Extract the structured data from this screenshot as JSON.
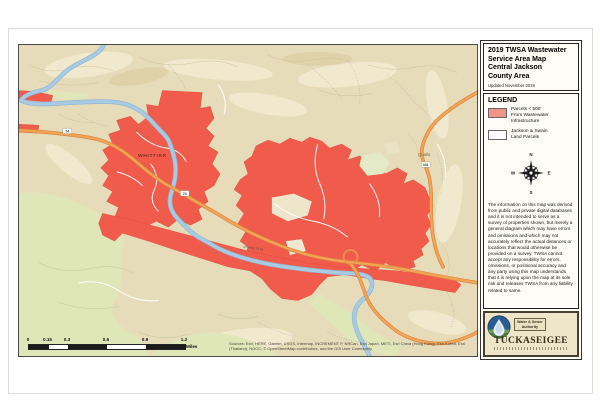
{
  "sheet": {
    "title_lines": [
      "2019 TWSA Wastewater",
      "Service Area Map",
      "Central Jackson",
      "County Area"
    ],
    "updated": "Updated November 2019"
  },
  "legend": {
    "header": "LEGEND",
    "items": [
      {
        "swatch_color": "#f2938a",
        "lines": [
          "Parcels < 500'",
          "From Wastewater",
          "Infrastructure"
        ]
      },
      {
        "swatch_color": "#ffffff",
        "lines": [
          "Jackson & Swain",
          "Land Parcels"
        ]
      }
    ]
  },
  "compass": {
    "n": "N",
    "e": "E",
    "s": "S",
    "w": "W"
  },
  "disclaimer": "The information on this map was derived from public and private digital databases and it is not intended to serve as a survey of properties shown, but merely a general diagram which may have errors and omissions and which may not accurately reflect the actual distances or locations that would otherwise be provided on a survey. TWSA cannot accept any responsibility for errors, omissions, or positional accuracy and any party using this map understands that it is relying upon the map at its sole risk and releases TWSA from any liability related to same.",
  "logo": {
    "authority_line1": "Water & Sewer",
    "authority_line2": "Authority",
    "name": "TUCKASEIGEE"
  },
  "scale_bar": {
    "ticks": [
      "0",
      "0.15",
      "0.3",
      "0.6",
      "0.9",
      "1.2"
    ],
    "unit": "Miles"
  },
  "attribution": "Sources: Esri, HERE, Garmin, USGS, Intermap, INCREMENT P, NRCan, Esri Japan, METI, Esri China (Hong Kong), Esri Korea, Esri (Thailand), NGCC, © OpenStreetMap contributors, and the GIS User Community",
  "map": {
    "labels": {
      "town": "WHITTIER",
      "community": "Qualla",
      "highway_name": "US Hwy 74 W"
    },
    "shields": [
      "74",
      "74",
      "441"
    ],
    "colors": {
      "service_area": "#f15b4b",
      "terrain": "#e7dcba",
      "forest": "#dfe7b9",
      "river": "#a9cbe2",
      "highway": "#f2a455"
    }
  }
}
